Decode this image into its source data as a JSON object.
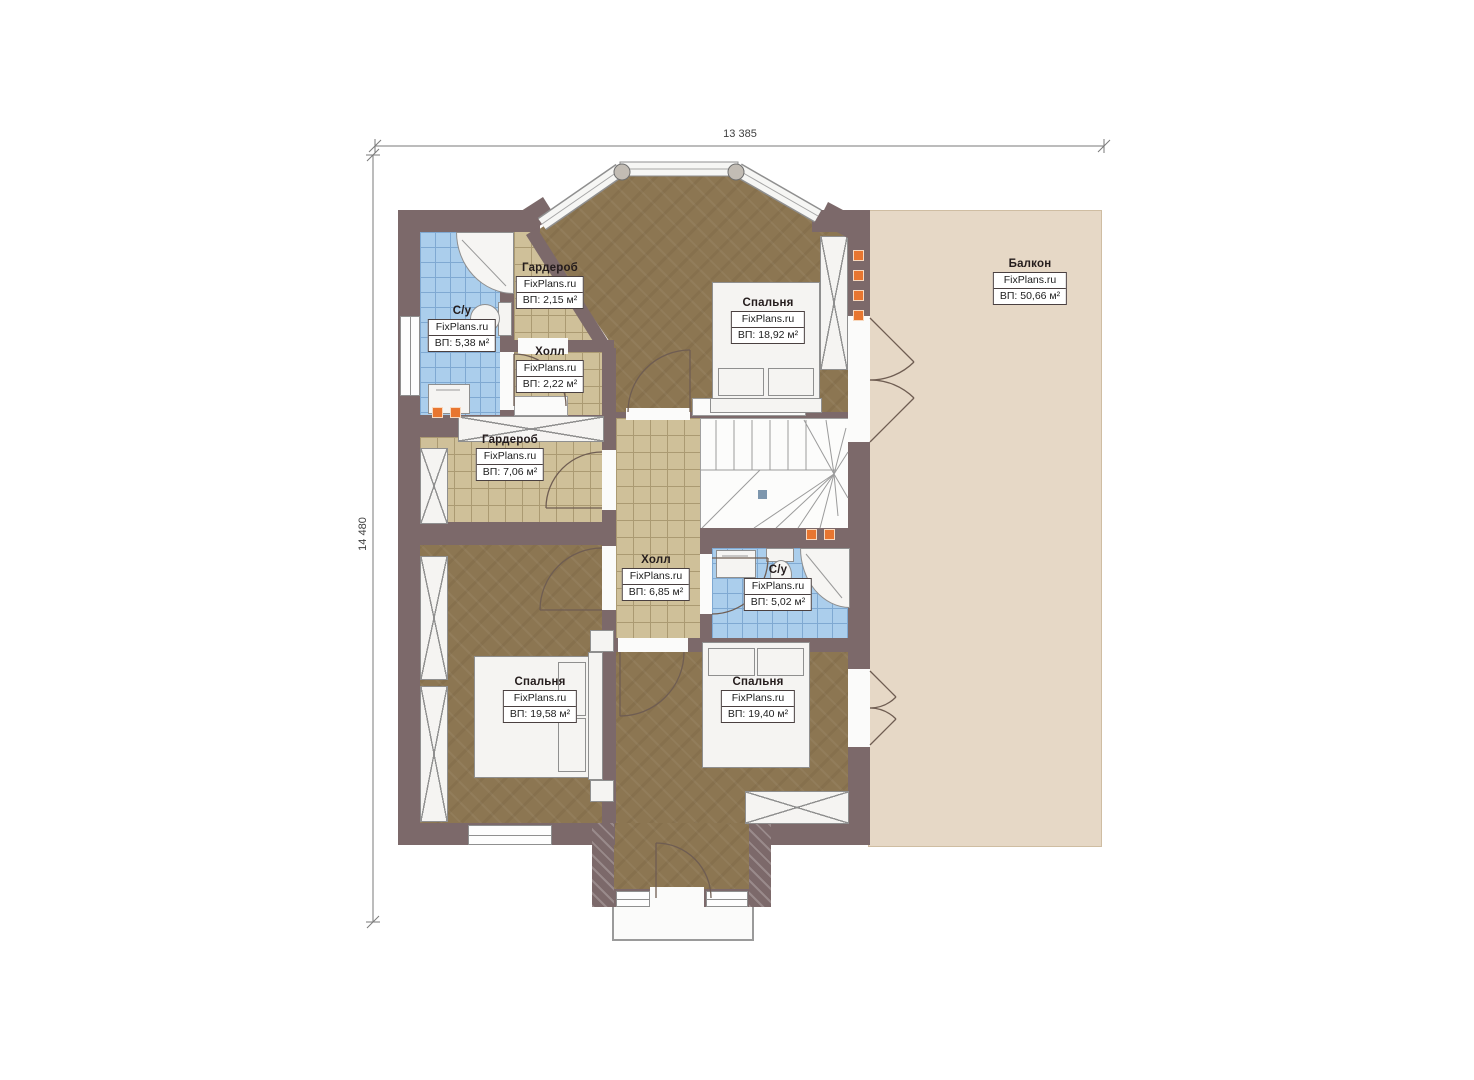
{
  "plan": {
    "title": "floor plan – second floor",
    "watermark": "FixPlans.ru",
    "dimension_top": "13 385",
    "dimension_left": "14 480",
    "rooms": [
      {
        "id": "su-top",
        "name": "С/у",
        "area": "ВП: 5,38 м²"
      },
      {
        "id": "wardrobe-small",
        "name": "Гардероб",
        "area": "ВП: 2,15 м²"
      },
      {
        "id": "hall-small",
        "name": "Холл",
        "area": "ВП: 2,22 м²"
      },
      {
        "id": "bedroom-top",
        "name": "Спальня",
        "area": "ВП: 18,92 м²"
      },
      {
        "id": "balcony",
        "name": "Балкон",
        "area": "ВП: 50,66 м²"
      },
      {
        "id": "wardrobe-big",
        "name": "Гардероб",
        "area": "ВП: 7,06 м²"
      },
      {
        "id": "hall-main",
        "name": "Холл",
        "area": "ВП: 6,85 м²"
      },
      {
        "id": "su-bottom",
        "name": "С/у",
        "area": "ВП: 5,02 м²"
      },
      {
        "id": "bedroom-left",
        "name": "Спальня",
        "area": "ВП: 19,58 м²"
      },
      {
        "id": "bedroom-right",
        "name": "Спальня",
        "area": "ВП: 19,40 м²"
      }
    ],
    "colors": {
      "wall": "#7c696a",
      "floor_wood": "#8c7652",
      "floor_tile_tan": "#cfc099",
      "floor_tile_blue": "#abceec",
      "balcony": "#e6d8c6",
      "accent_orange": "#e87630"
    }
  }
}
